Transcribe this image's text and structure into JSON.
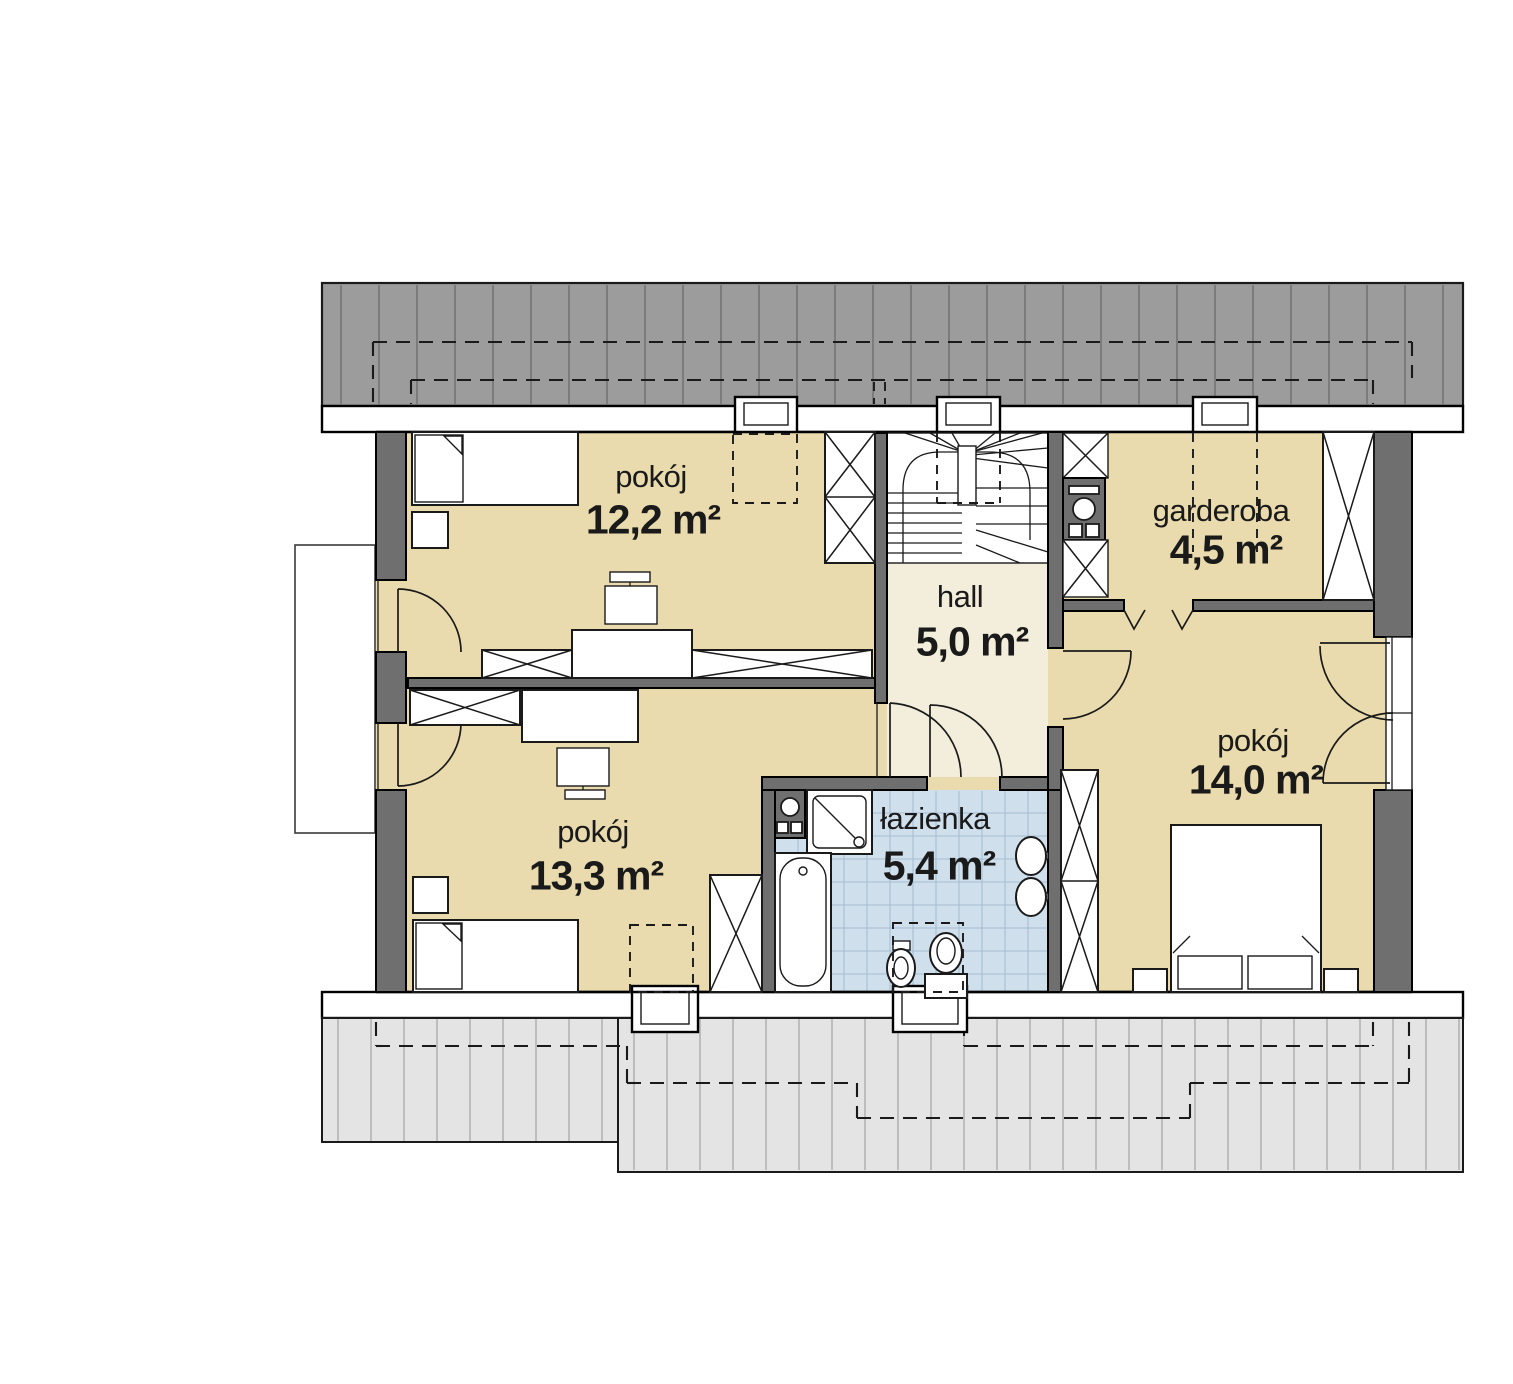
{
  "rooms": [
    {
      "id": "pokoj-gorny-lewy",
      "name": "pokój",
      "area": "12,2 m²"
    },
    {
      "id": "garderoba",
      "name": "garderoba",
      "area": "4,5 m²"
    },
    {
      "id": "hall",
      "name": "hall",
      "area": "5,0 m²"
    },
    {
      "id": "pokoj-prawy",
      "name": "pokój",
      "area": "14,0 m²"
    },
    {
      "id": "pokoj-dolny-lewy",
      "name": "pokój",
      "area": "13,3 m²"
    },
    {
      "id": "lazienka",
      "name": "łazienka",
      "area": "5,4 m²"
    }
  ],
  "colors": {
    "floor": "#E9DBAD",
    "hall_floor": "#F3EDDB",
    "bath_tile": "#D0DFEC",
    "tile_grid": "#A6BED3",
    "roof_dark": "#9C9C9C",
    "roof_dark_stripe": "#757575",
    "roof_light": "#E4E4E4",
    "roof_light_stripe": "#A3A3A3",
    "wall": "#6F6F6F",
    "line": "#1A1A1A"
  }
}
